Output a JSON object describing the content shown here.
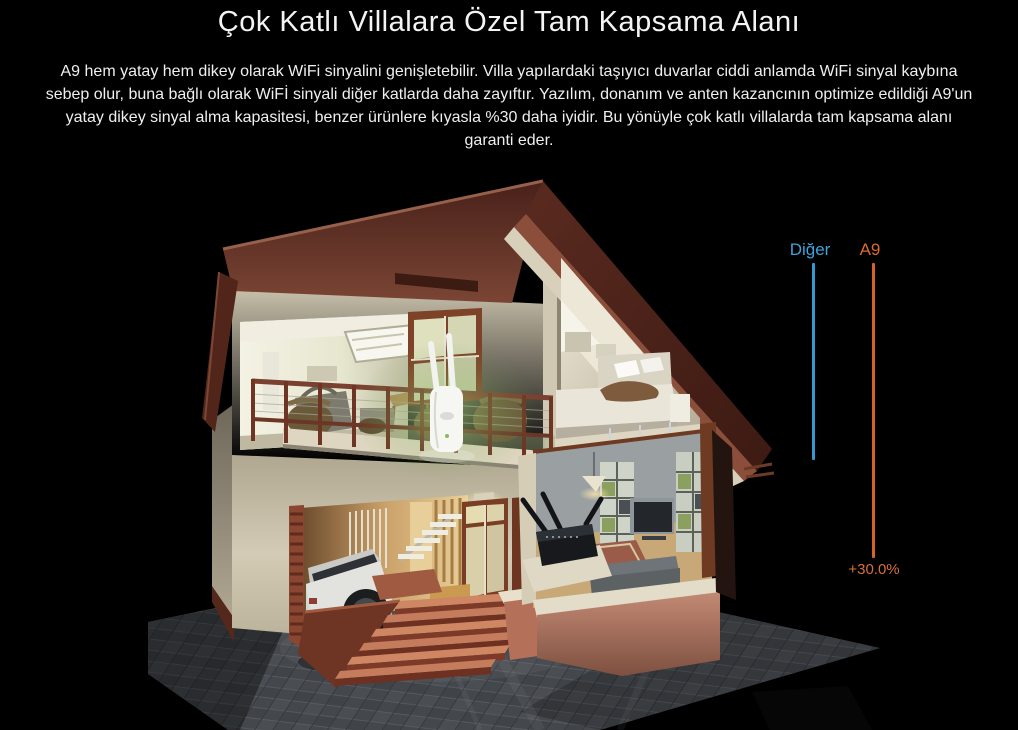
{
  "page": {
    "title": "Çok Katlı Villalara Özel Tam Kapsama Alanı",
    "description": "A9 hem yatay hem dikey olarak WiFi sinyalini genişletebilir. Villa yapılardaki taşıyıcı duvarlar ciddi anlamda WiFi sinyal kaybına sebep olur, buna bağlı olarak WiFİ sinyali diğer katlarda daha zayıftır. Yazılım, donanım ve anten kazancının optimize edildiği A9'un yatay dikey sinyal alma kapasitesi, benzer ürünlere kıyasla %30 daha iyidir. Bu yönüyle çok katlı villalarda tam kapsama alanı garanti eder.",
    "background_color": "#000000",
    "text_color": "#f4f4f4"
  },
  "comparison": {
    "series": [
      {
        "label": "Diğer",
        "color": "#3fa3dc"
      },
      {
        "label": "A9",
        "color": "#dc6a2f"
      }
    ],
    "gain_label": "+30.0%"
  },
  "chart_data": {
    "type": "bar",
    "categories": [
      "Diğer",
      "A9"
    ],
    "values": [
      100,
      130
    ],
    "title": "",
    "xlabel": "",
    "ylabel": "Dikey kapsama (göreli)",
    "annotations": [
      "+30.0%"
    ],
    "legend_position": "top",
    "series_colors": [
      "#3fa3dc",
      "#dc6a2f"
    ],
    "grid": false
  },
  "illustration": {
    "name": "multi-story-villa-cutaway-render",
    "elements": [
      "roof",
      "attic-bedroom",
      "gym-room",
      "balcony",
      "a9-repeater-device",
      "signal-glow",
      "middle-window",
      "garage",
      "suv-car",
      "interior-stairs",
      "entrance-door",
      "entrance-steps",
      "living-room",
      "router-device",
      "tiled-ground"
    ]
  }
}
